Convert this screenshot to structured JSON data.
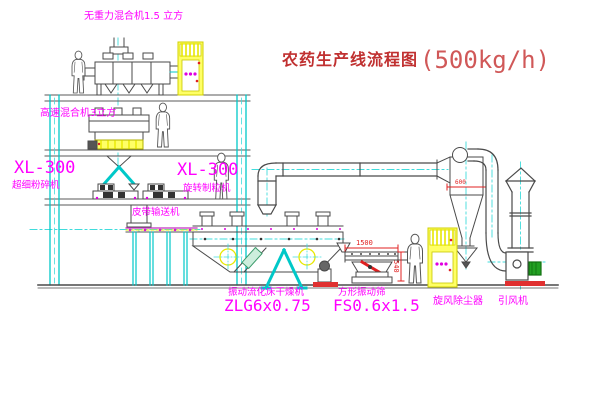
{
  "title": {
    "name": "农药生产线流程图",
    "capacity": "(500kg/h)"
  },
  "equipment_labels": {
    "gravity_mixer": "无重力混合机1.5 立方",
    "high_speed_mixer": "高速混合机3立方",
    "mill_model": "XL-300",
    "mill_name": "超细粉碎机",
    "granulator_model": "XL-300",
    "granulator_name": "旋转制粒机",
    "belt_conveyor": "皮带输送机",
    "dryer_name": "振动流化床干燥机",
    "dryer_model": "ZLG6x0.75",
    "sieve_name": "方形振动筛",
    "sieve_model": "FS0.6x1.5",
    "cyclone": "旋风除尘器",
    "fan": "引风机"
  },
  "dimensions": {
    "sieve_length": "1500",
    "sieve_height": "540",
    "cyclone_diameter": "600"
  },
  "colors": {
    "structure_cyan": "#00c8c8",
    "equipment_dark": "#4a4a4a",
    "label_magenta": "#ff00ff",
    "title_red": "#c03030",
    "dimension_red": "#e02020",
    "cabinet_yellow": "#ffff66",
    "motor_green": "#22a022"
  }
}
